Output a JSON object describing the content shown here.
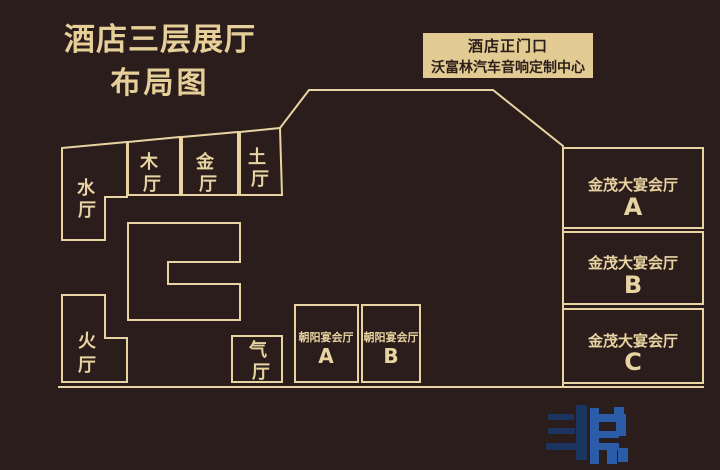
{
  "title": {
    "line1": "酒店三层展厅",
    "line2": "布局图"
  },
  "entrance_sign": {
    "line1": "酒店正门口",
    "line2": "沃富林汽车音响定制中心"
  },
  "floor_plan": {
    "element_halls": [
      {
        "id": "water",
        "chars": [
          "水",
          "厅"
        ]
      },
      {
        "id": "wood",
        "chars": [
          "木",
          "厅"
        ]
      },
      {
        "id": "gold",
        "chars": [
          "金",
          "厅"
        ]
      },
      {
        "id": "earth",
        "chars": [
          "土",
          "厅"
        ]
      },
      {
        "id": "fire",
        "chars": [
          "火",
          "厅"
        ]
      },
      {
        "id": "air",
        "chars": [
          "气",
          "厅"
        ]
      }
    ],
    "banquet_halls": [
      {
        "id": "chaoyang-a",
        "name": "朝阳宴会厅",
        "letter": "A"
      },
      {
        "id": "chaoyang-b",
        "name": "朝阳宴会厅",
        "letter": "B"
      },
      {
        "id": "jinmao-a",
        "name": "金茂大宴会厅",
        "letter": "A"
      },
      {
        "id": "jinmao-b",
        "name": "金茂大宴会厅",
        "letter": "B"
      },
      {
        "id": "jinmao-c",
        "name": "金茂大宴会厅",
        "letter": "C"
      }
    ]
  },
  "colors": {
    "background": "#2a1d1b",
    "line_gold": "#e8d3a2",
    "title_gold": "#e6cf98",
    "entrance_fill": "#e2cb93",
    "entrance_text": "#2b1e19",
    "watermark_dark_blue": "#1b3560",
    "watermark_light_blue": "#2a5ca8"
  }
}
